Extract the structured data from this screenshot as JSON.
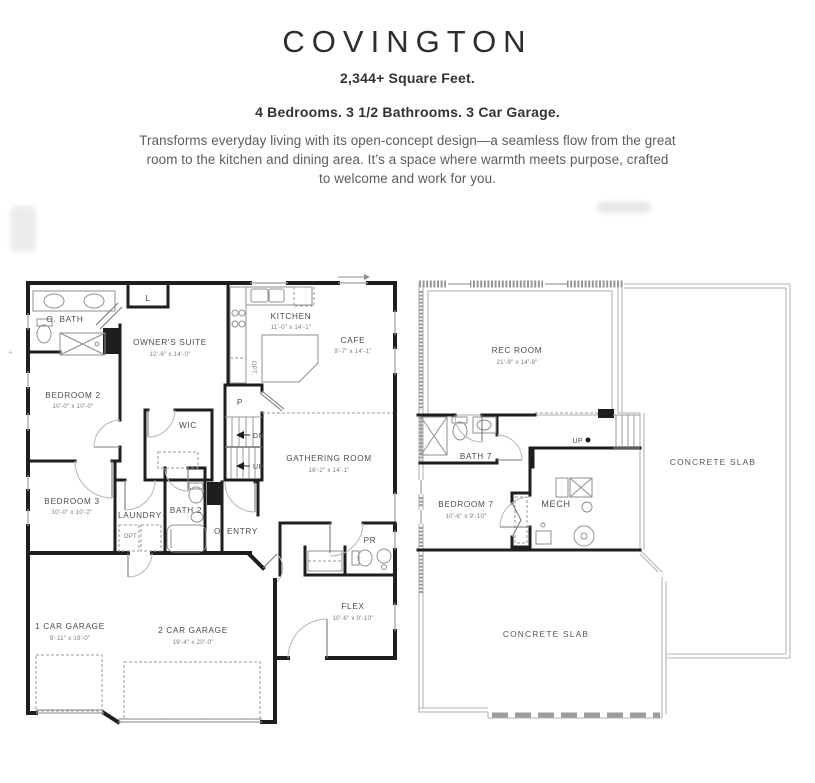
{
  "header": {
    "title": "COVINGTON",
    "stats_line1": "2,344+ Square Feet.",
    "stats_line2": "4 Bedrooms.  3 1/2 Bathrooms.  3 Car Garage.",
    "description_lines": [
      "Transforms everyday living with its open-concept design—a seamless flow from the great",
      "room to the kitchen and dining area. It’s a space where warmth meets purpose, crafted",
      "to welcome and work for you."
    ]
  },
  "plan1": {
    "name": "First Floor",
    "rooms": {
      "obath": {
        "name": "O. BATH"
      },
      "linen": {
        "name": "L"
      },
      "owners": {
        "name": "OWNER'S SUITE",
        "dims": "12'-6\" x 14'-0\""
      },
      "kitchen": {
        "name": "KITCHEN",
        "dims": "11'-0\" x 14'-1\""
      },
      "cafe": {
        "name": "CAFE",
        "dims": "9'-7\" x 14'-1\""
      },
      "bedroom2": {
        "name": "BEDROOM 2",
        "dims": "10'-0\" x 10'-0\""
      },
      "wic": {
        "name": "WIC"
      },
      "gathering": {
        "name": "GATHERING ROOM",
        "dims": "16'-2\" x 14'-1\""
      },
      "bedroom3": {
        "name": "BEDROOM 3",
        "dims": "10'-0\" x 10'-2\""
      },
      "laundry": {
        "name": "LAUNDRY"
      },
      "bath2": {
        "name": "BATH 2"
      },
      "oentry": {
        "name": "O. ENTRY"
      },
      "pantry": {
        "name": "P"
      },
      "pr": {
        "name": "PR"
      },
      "flex": {
        "name": "FLEX",
        "dims": "10'-6\" x 9'-10\""
      },
      "garage1": {
        "name": "1 CAR GARAGE",
        "dims": "9'-11\" x 19'-0\""
      },
      "garage2": {
        "name": "2 CAR GARAGE",
        "dims": "19'-4\" x 20'-0\""
      }
    },
    "markers": {
      "dn": "DN",
      "up": "UP",
      "opt_kitchen": "OPT.",
      "opt_laundry": "OPT."
    }
  },
  "plan2": {
    "name": "Basement",
    "rooms": {
      "rec": {
        "name": "REC ROOM",
        "dims": "21'-9\" x 14'-8\""
      },
      "bath7": {
        "name": "BATH 7"
      },
      "bedroom7": {
        "name": "BEDROOM 7",
        "dims": "10'-6\" x 9'-10\""
      },
      "mech": {
        "name": "MECH"
      },
      "slab_right": {
        "name": "CONCRETE SLAB"
      },
      "slab_bottom": {
        "name": "CONCRETE SLAB"
      }
    },
    "markers": {
      "up": "UP"
    }
  },
  "colors": {
    "wall": "#1e1e1e",
    "foundation": "#b3b3b3",
    "label_text": "#4c4c4c"
  }
}
